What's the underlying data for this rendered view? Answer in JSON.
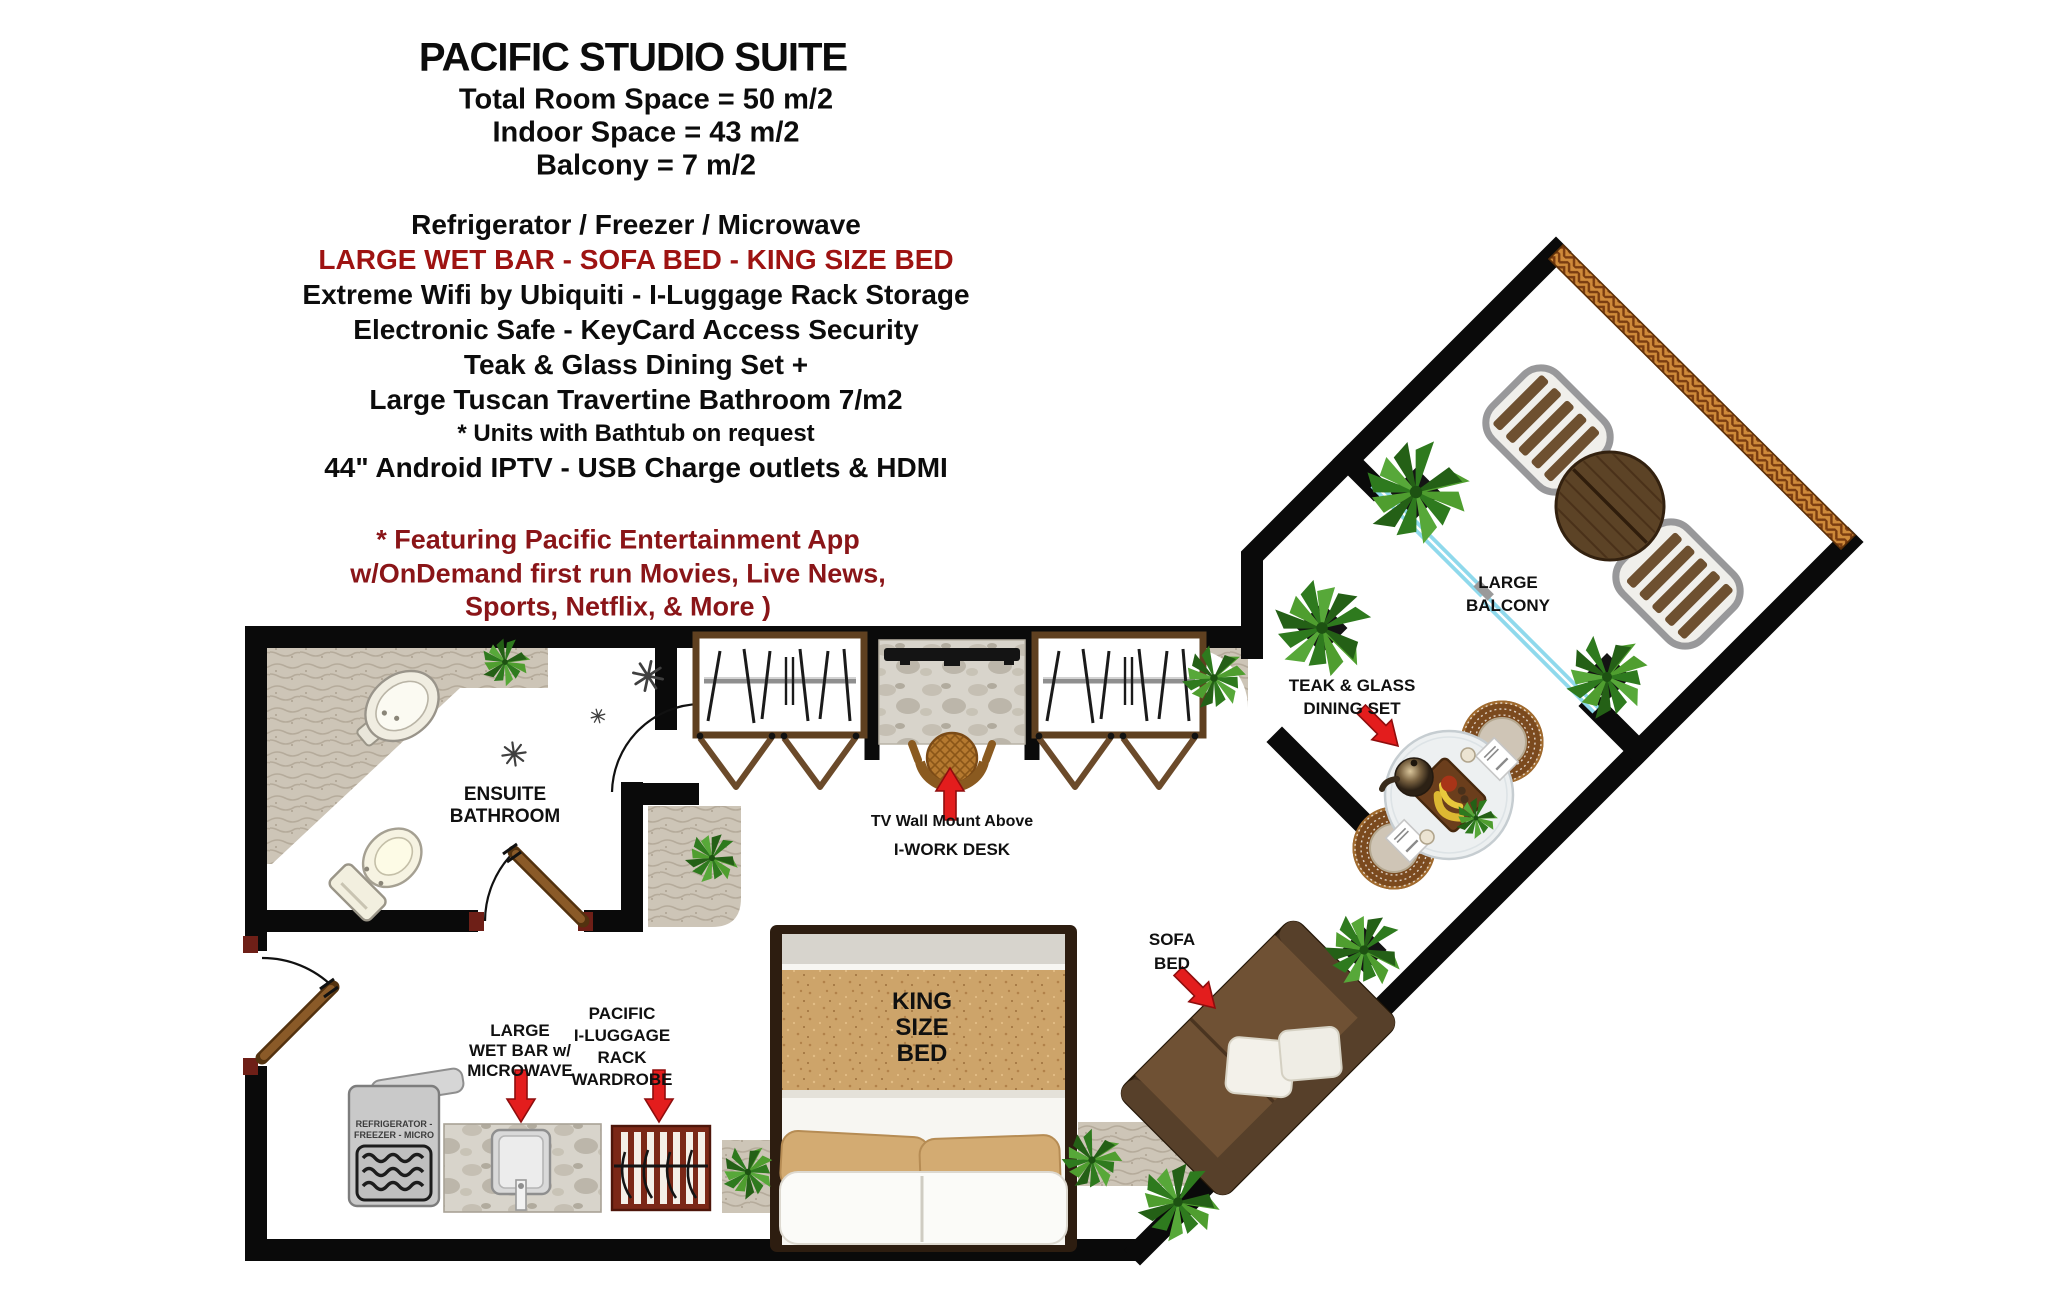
{
  "title": "PACIFIC STUDIO SUITE",
  "specs": [
    "Total Room Space = 50 m/2",
    "Indoor Space = 43 m/2",
    "Balcony  = 7 m/2"
  ],
  "features": [
    "Refrigerator / Freezer / Microwave",
    "LARGE WET BAR - SOFA BED - KING SIZE BED",
    "Extreme Wifi by Ubiquiti - I-Luggage Rack Storage",
    "Electronic Safe - KeyCard Access Security",
    "Teak & Glass Dining Set +",
    "Large Tuscan Travertine Bathroom 7/m2",
    "* Units with Bathtub on request",
    "44\" Android IPTV - USB Charge outlets & HDMI"
  ],
  "promo": [
    "* Featuring  Pacific Entertainment App",
    "w/OnDemand first run Movies, Live News,",
    "Sports, Netflix, & More )"
  ],
  "plan": {
    "ensuite": [
      "ENSUITE",
      "BATHROOM"
    ],
    "tv_mount": "TV Wall Mount Above",
    "work_desk": "I-WORK DESK",
    "balcony": [
      "LARGE",
      "BALCONY"
    ],
    "dining": [
      "TEAK & GLASS",
      "DINING SET"
    ],
    "sofa": [
      "SOFA",
      "BED"
    ],
    "king_bed": [
      "KING",
      "SIZE",
      "BED"
    ],
    "wet_bar": [
      "LARGE",
      "WET BAR w/",
      "MICROWAVE"
    ],
    "luggage": [
      "PACIFIC",
      "I-LUGGAGE",
      "RACK",
      "WARDROBE"
    ],
    "fridge": [
      "REFRIGERATOR -",
      "FREEZER - MICRO"
    ]
  },
  "colors": {
    "wall": "#0a0a0a",
    "feature_red": "#9e1312",
    "promo_maroon": "#8a1518",
    "arrow_red": "#e31d1d",
    "stone_floor": "#cdc5b7",
    "sand_blanket": "#cda46a",
    "slider_blue": "#8fd9ec",
    "railing_orange": "#cf8a3a",
    "plant_green": "#2e7a1e",
    "wood_door": "#8a5a28"
  },
  "icons": [
    "plant-icon",
    "shower-spray-icon",
    "red-arrow-icon",
    "door-swing-icon",
    "sliding-door-icon",
    "balcony-railing-icon"
  ]
}
